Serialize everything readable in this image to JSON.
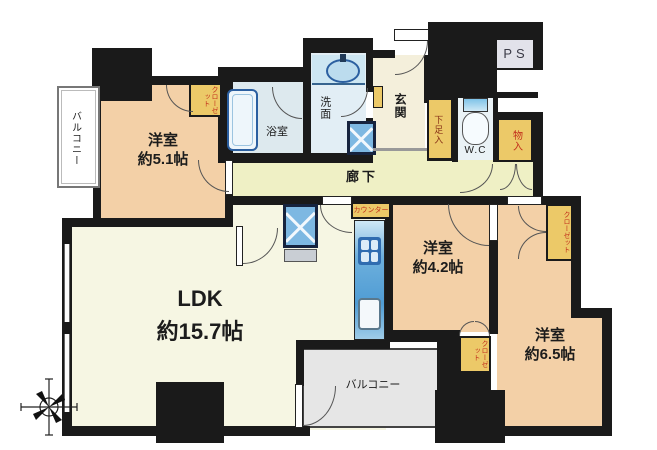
{
  "rooms": {
    "balcony_left": {
      "label": "バルコニー"
    },
    "bedroom_51": {
      "label": "洋室",
      "size": "約5.1帖"
    },
    "closet_51": {
      "label": "クローゼット"
    },
    "bath": {
      "label": "浴室"
    },
    "washroom": {
      "label": "洗面"
    },
    "genkan": {
      "label": "玄関"
    },
    "shoe_storage": {
      "label": "下足入"
    },
    "wc": {
      "label": "W.C"
    },
    "ps": {
      "label": "PS"
    },
    "storage": {
      "label": "物入"
    },
    "corridor": {
      "label": "廊下"
    },
    "kitchen_tag": {
      "label": "カウンター"
    },
    "bedroom_42": {
      "label": "洋室",
      "size": "約4.2帖"
    },
    "closet_65": {
      "label": "クローゼット"
    },
    "closet_42": {
      "label": "クローゼット"
    },
    "bedroom_65": {
      "label": "洋室",
      "size": "約6.5帖"
    },
    "ldk": {
      "label": "LDK",
      "size": "約15.7帖"
    },
    "balcony_bottom": {
      "label": "バルコニー"
    }
  },
  "colors": {
    "wall": "#1a1a1a",
    "room_peach": "#f3d0a7",
    "ldk_cream": "#f6f6e3",
    "corridor_yellow": "#eff0c5",
    "genkan_cream": "#f4efdb",
    "bath_blue": "#dde9ee",
    "closet_yellow": "#ecc968",
    "closet_text_red": "#c2301c",
    "balcony_gray": "#e6e6e6",
    "kitchen_blue": "#5aa2d4",
    "fixture_blue": "#7db8e2"
  }
}
